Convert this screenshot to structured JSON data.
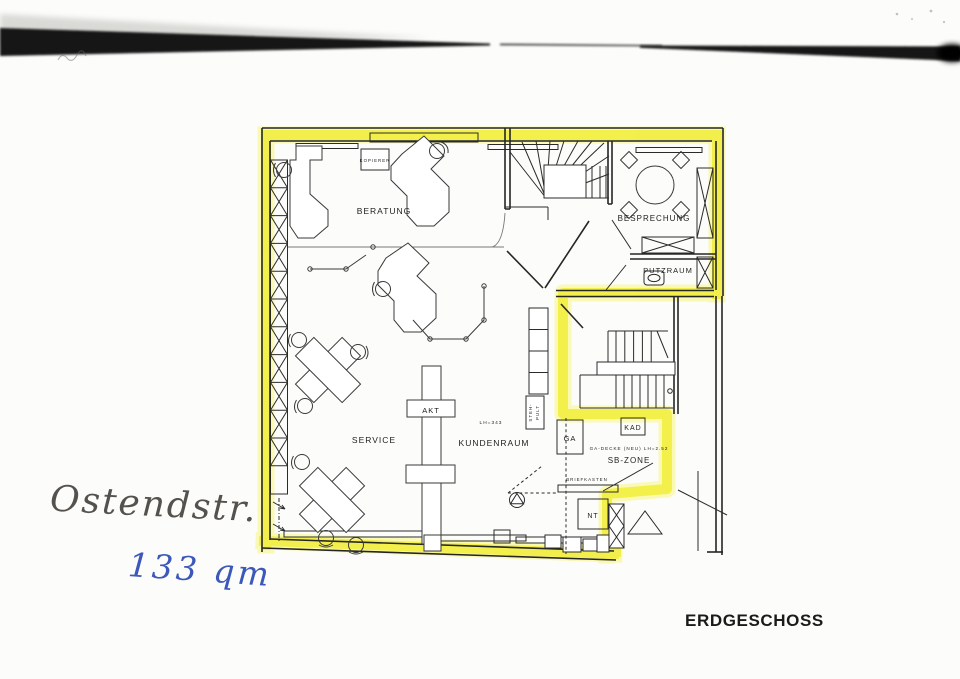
{
  "plan": {
    "floor_label": "ERDGESCHOSS",
    "highlight_color": "#f1ee3a",
    "rooms": {
      "beratung": "BERATUNG",
      "besprechung": "BESPRECHUNG",
      "putzraum": "PUTZRAUM",
      "service": "SERVICE",
      "kundenraum": "KUNDENRAUM",
      "sb_zone": "SB-ZONE"
    },
    "items": {
      "kopierer": "KOPIERER",
      "akt": "AKT",
      "steh_pult_line1": "STEH-",
      "steh_pult_line2": "PULT",
      "ga": "GA",
      "kad": "KAD",
      "nt": "NT",
      "briefkasten": "BRIEFKASTEN"
    },
    "notes": {
      "lh_kundenraum": "LH=343",
      "ga_decke": "GA-DECKE (NEU) LH=2.52"
    }
  },
  "handwriting": {
    "street": "Ostendstr.",
    "area": "133 qm"
  }
}
